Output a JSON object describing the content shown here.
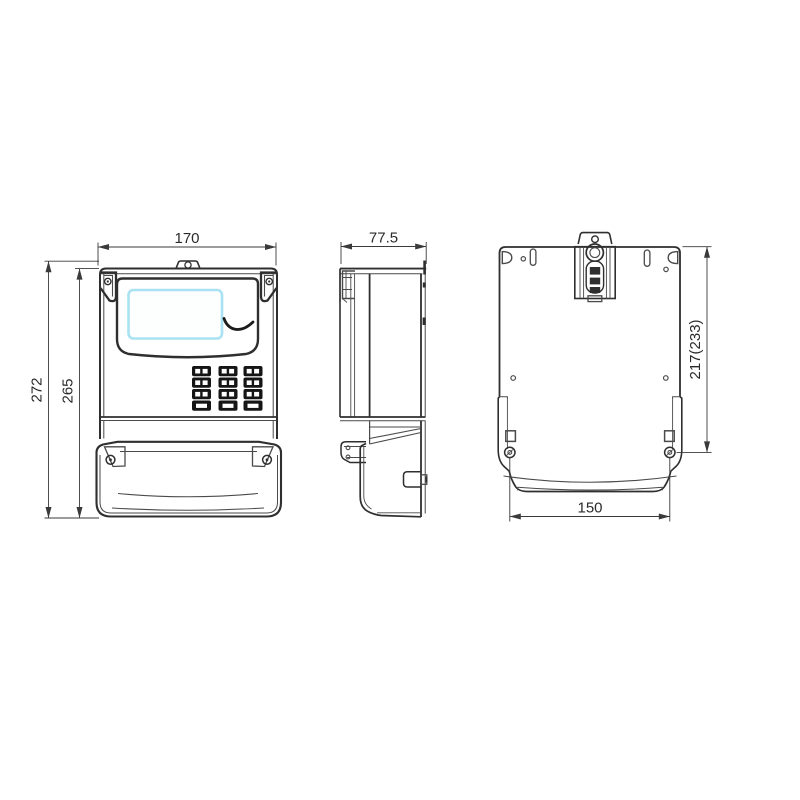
{
  "drawing": {
    "type": "technical-orthographic-views",
    "dimensions": {
      "front_width": "170",
      "side_depth": "77.5",
      "overall_height": "272",
      "body_height": "265",
      "mounting_height": "217(233)",
      "terminal_cover_width": "150"
    },
    "colors": {
      "line": "#2f2f2f",
      "dimension_line": "#3a3a3a",
      "lcd_border": "#a9e2f2",
      "keypad_button": "#151515",
      "background": "#ffffff"
    }
  }
}
